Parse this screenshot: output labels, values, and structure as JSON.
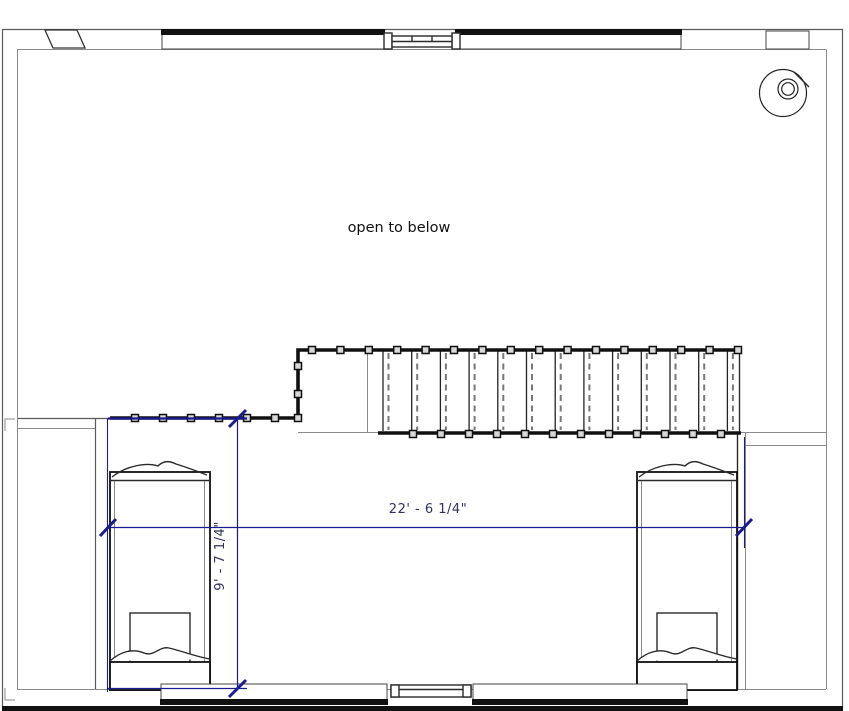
{
  "title": "upper floor plan",
  "labels": {
    "open_area": "open to below"
  },
  "dimensions": {
    "horizontal": {
      "text": "22' - 6 1/4\""
    },
    "vertical": {
      "text": "9' - 7 1/4\""
    }
  },
  "colors": {
    "dimension": "#1b1b8f",
    "dimension_text": "#33335c",
    "wall_black": "#111111",
    "line_gray": "#5a5a5a",
    "label_text": "#111111",
    "background": "#ffffff"
  },
  "fixtures": {
    "toilet": "toilet",
    "bed_left": "bed",
    "bed_right": "bed",
    "staircase": "staircase",
    "railing": "guard railing"
  },
  "stairs": {
    "tread_count": 13,
    "tread_start_x": 383,
    "tread_spacing": 28.7,
    "dash_offset": 5.5,
    "top_y": 351,
    "bottom_y": 431
  },
  "railing": {
    "post_size": 7,
    "segments": [
      {
        "axis": "x",
        "y": 418,
        "start": 135,
        "step": 28,
        "count": 6
      },
      {
        "axis": "y",
        "x": 298,
        "ys": [
          366,
          394,
          418
        ]
      },
      {
        "axis": "x",
        "y": 350,
        "start": 312,
        "step": 28.4,
        "count": 16
      },
      {
        "axis": "x",
        "y": 434,
        "start": 413,
        "step": 28,
        "count": 12
      }
    ]
  }
}
